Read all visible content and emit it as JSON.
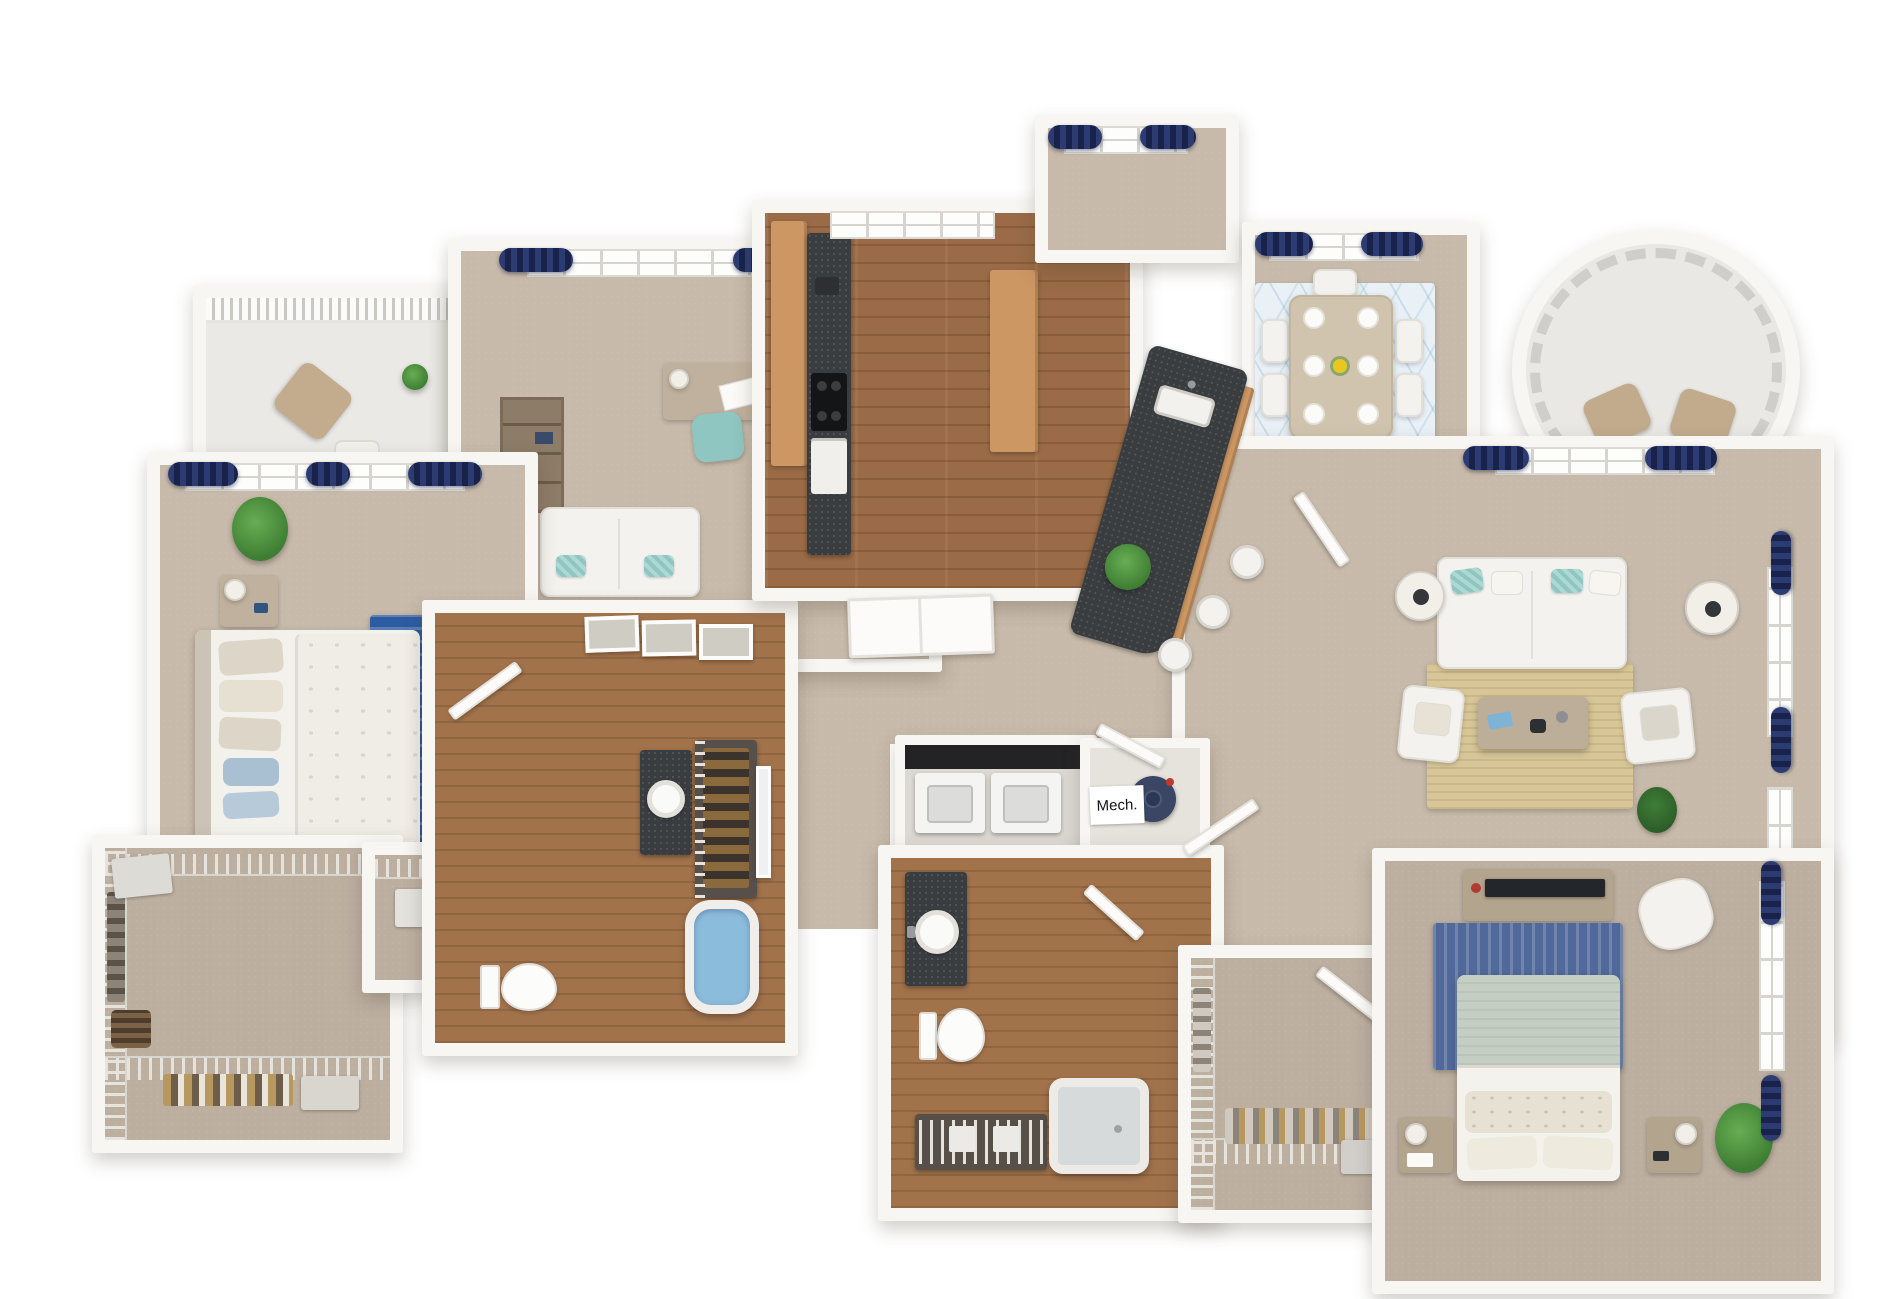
{
  "scene": {
    "type": "3d-apartment-floor-plan-render",
    "text_labels": {
      "mech_room": "Mech."
    },
    "palette": {
      "background": "#ffffff",
      "wall": "#f7f6f2",
      "carpet": "#c7baaa",
      "wood_floor": "#9a6b46",
      "bath_wood_floor": "#a2734b",
      "balcony_floor": "#eae9e5",
      "granite_counter": "#3a3d40",
      "cabinet_tan": "#cd9763",
      "curtain_navy": "#1f2c5c",
      "accent_teal": "#9fd3cf",
      "rug_blue": "#2e5ca3",
      "rug_master_blue": "#51699a",
      "rug_jute": "#d7c697",
      "rug_dining": "#e9f1f6",
      "tub_water_blue": "#8cbcdc",
      "plant_green": "#4e9244",
      "furniture_white": "#f4f2ee",
      "furniture_tan": "#bfb19d"
    },
    "rooms": [
      "balcony",
      "bedroom",
      "bedroom-closet",
      "office-den",
      "walk-in-closet",
      "linen-closet",
      "bathroom",
      "kitchen",
      "dining-nook",
      "dining-room",
      "round-balcony",
      "living-room",
      "hallway",
      "laundry-closet",
      "mechanical-closet",
      "second-bathroom",
      "master-walk-in-closet",
      "master-bedroom"
    ],
    "fixtures": [
      "bed",
      "nightstand",
      "table-lamp",
      "area-rug",
      "desk",
      "office-chair",
      "bookshelf",
      "loveseat",
      "floor-lamp",
      "potted-plant",
      "kitchen-island",
      "island-sink",
      "bar-stool",
      "cooktop",
      "oven",
      "pantry-cabinet",
      "dining-table",
      "dining-chair",
      "place-setting",
      "sofa",
      "armchair",
      "coffee-table",
      "side-table",
      "tv-console",
      "tv",
      "dresser",
      "toilet",
      "soaking-tub",
      "shower-tub",
      "vanity-sink",
      "washer",
      "dryer",
      "water-heater",
      "wire-shelving",
      "window",
      "curtains",
      "door",
      "railing",
      "picture-frame",
      "patio-chair",
      "patio-table"
    ]
  }
}
